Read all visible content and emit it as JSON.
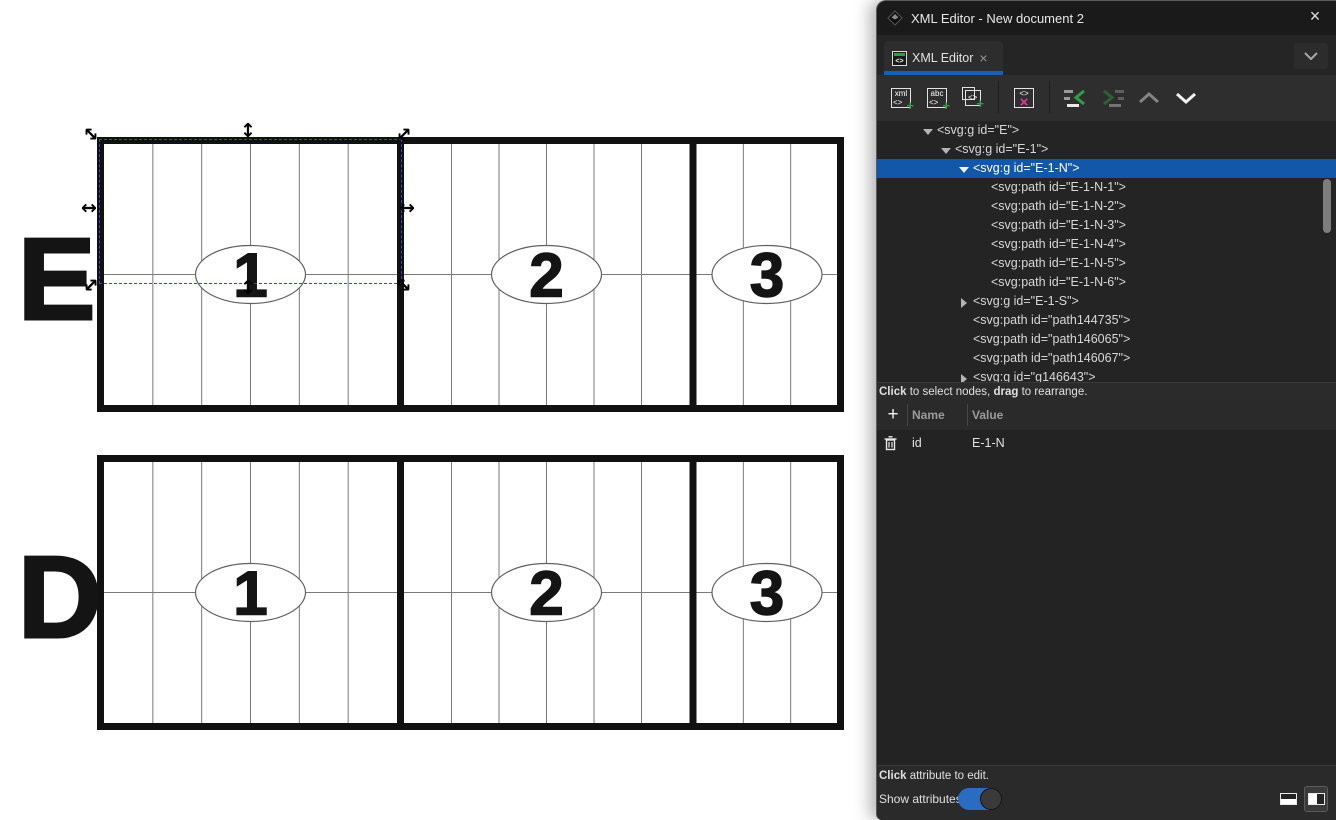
{
  "canvas": {
    "grids": [
      {
        "label": "E",
        "sections": [
          {
            "number": "1",
            "columns": 6
          },
          {
            "number": "2",
            "columns": 6
          },
          {
            "number": "3",
            "columns": 3
          }
        ]
      },
      {
        "label": "D",
        "sections": [
          {
            "number": "1",
            "columns": 6
          },
          {
            "number": "2",
            "columns": 6
          },
          {
            "number": "3",
            "columns": 3
          }
        ]
      }
    ],
    "selection_color": "#3847c0"
  },
  "panel": {
    "title": "XML Editor - New document 2",
    "window_close": "×",
    "tab": {
      "label": "XML Editor",
      "close": "×"
    },
    "toolbar": {
      "new_element_text": "xml",
      "new_text_text": "abc",
      "tag_glyph": "<>",
      "plus_glyph": "+",
      "delete_glyph": "×"
    },
    "tree": {
      "nodes": [
        {
          "text": "<svg:g id=\"E\">",
          "indent": 1,
          "expander": "open",
          "selected": false
        },
        {
          "text": "<svg:g id=\"E-1\">",
          "indent": 2,
          "expander": "open",
          "selected": false
        },
        {
          "text": "<svg:g id=\"E-1-N\">",
          "indent": 3,
          "expander": "open",
          "selected": true
        },
        {
          "text": "<svg:path id=\"E-1-N-1\">",
          "indent": 4,
          "expander": "none",
          "selected": false
        },
        {
          "text": "<svg:path id=\"E-1-N-2\">",
          "indent": 4,
          "expander": "none",
          "selected": false
        },
        {
          "text": "<svg:path id=\"E-1-N-3\">",
          "indent": 4,
          "expander": "none",
          "selected": false
        },
        {
          "text": "<svg:path id=\"E-1-N-4\">",
          "indent": 4,
          "expander": "none",
          "selected": false
        },
        {
          "text": "<svg:path id=\"E-1-N-5\">",
          "indent": 4,
          "expander": "none",
          "selected": false
        },
        {
          "text": "<svg:path id=\"E-1-N-6\">",
          "indent": 4,
          "expander": "none",
          "selected": false
        },
        {
          "text": "<svg:g id=\"E-1-S\">",
          "indent": 3,
          "expander": "closed",
          "selected": false
        },
        {
          "text": "<svg:path id=\"path144735\">",
          "indent": 3,
          "expander": "none",
          "selected": false
        },
        {
          "text": "<svg:path id=\"path146065\">",
          "indent": 3,
          "expander": "none",
          "selected": false
        },
        {
          "text": "<svg:path id=\"path146067\">",
          "indent": 3,
          "expander": "none",
          "selected": false
        },
        {
          "text": "<svg:g id=\"g146643\">",
          "indent": 3,
          "expander": "closed",
          "selected": false
        }
      ],
      "hint": {
        "bold1": "Click",
        "mid": " to select nodes, ",
        "bold2": "drag",
        "end": " to rearrange."
      }
    },
    "attributes": {
      "add_glyph": "+",
      "columns": {
        "name": "Name",
        "value": "Value"
      },
      "rows": [
        {
          "name": "id",
          "value": "E-1-N"
        }
      ],
      "edit_hint": {
        "bold": "Click",
        "rest": " attribute to edit."
      },
      "show_attributes_label": "Show attributes",
      "show_attributes_on": true
    }
  },
  "colors": {
    "selected_row": "#1257a8",
    "tab_underline": "#1a5fb4",
    "toggle_on": "#2a6cc0",
    "icon_green": "#2f9e44",
    "icon_pink": "#e5399e"
  }
}
